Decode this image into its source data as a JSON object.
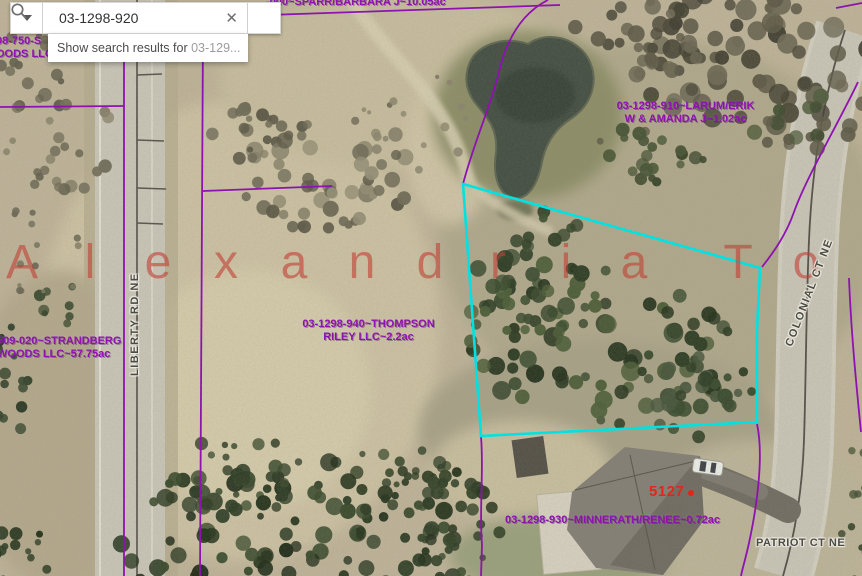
{
  "search": {
    "value": "03-1298-920",
    "clear_glyph": "✕",
    "suggestion_prefix": "Show search results for ",
    "suggestion_query": "03-129..."
  },
  "watermark": {
    "text": "Alexandria To",
    "letters": [
      "A",
      "l",
      "e",
      "x",
      "a",
      "n",
      "d",
      "r",
      "i",
      "a",
      " ",
      "T",
      "o"
    ],
    "color": "rgba(193,64,52,0.6)"
  },
  "parcels": {
    "sparr": {
      "label": "-000~SPARR/BARBARA J~10.05ac"
    },
    "strandberg_north": {
      "line1": "08-750-S",
      "line2": "OODS LLC"
    },
    "larum": {
      "line1": "03-1298-910~LARUM/ERIK",
      "line2": "W & AMANDA J~1.02ac"
    },
    "strandberg": {
      "line1": "909-020~STRANDBERG",
      "line2": "WOODS LLC~57.75ac"
    },
    "thompson": {
      "line1": "03-1298-940~THOMPSON",
      "line2": "RILEY LLC~2.2ac"
    },
    "minnerath": {
      "label": "03-1298-930~MINNERATH/RENEE~0.72ac"
    }
  },
  "roads": {
    "liberty": "LIBERTY RD NE",
    "colonial": "COLONIAL CT NE",
    "patriot": "PATRIOT CT NE"
  },
  "house_number": "5127",
  "colors": {
    "parcel_line": "#8e12b0",
    "parcel_label": "#8e12b0",
    "selection_highlight": "#00e2e2",
    "road_label": "#4c4c46",
    "house_number": "#e3261b",
    "watermark": "#c14034"
  }
}
